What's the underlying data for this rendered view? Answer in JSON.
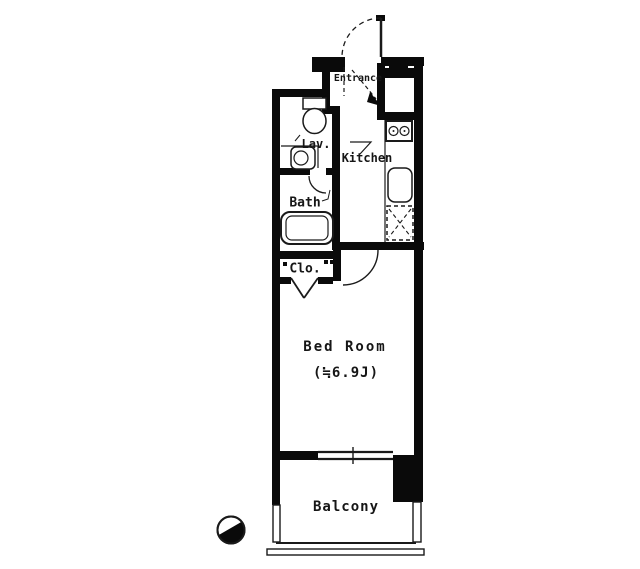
{
  "meta": {
    "type": "apartment-floor-plan"
  },
  "colors": {
    "wall": "#0a0a0a",
    "line": "#1a1a1a",
    "background": "#ffffff"
  },
  "rooms": {
    "entrance": {
      "label": "Entrance"
    },
    "lavatory": {
      "label": "Lav."
    },
    "kitchen": {
      "label": "Kitchen"
    },
    "bath": {
      "label": "Bath"
    },
    "closet": {
      "label": "Clo."
    },
    "bedroom": {
      "label": "Bed Room",
      "area": "(≒6.9J)"
    },
    "balcony": {
      "label": "Balcony"
    }
  },
  "fixtures": [
    {
      "name": "toilet",
      "room": "lavatory"
    },
    {
      "name": "washbasin",
      "room": "lavatory"
    },
    {
      "name": "bathtub",
      "room": "bath"
    },
    {
      "name": "stove-two-burner",
      "room": "kitchen"
    },
    {
      "name": "kitchen-sink",
      "room": "kitchen"
    },
    {
      "name": "refrigerator-space",
      "room": "kitchen"
    },
    {
      "name": "meter-box",
      "room": "entrance"
    },
    {
      "name": "closet-folding-door",
      "room": "closet"
    },
    {
      "name": "entrance-door-swing",
      "room": "entrance"
    },
    {
      "name": "bedroom-door-swing",
      "room": "bedroom"
    },
    {
      "name": "bath-door-swing",
      "room": "bath"
    },
    {
      "name": "sliding-window",
      "room": "bedroom"
    }
  ],
  "symbols": {
    "north_indicator": "compass-wedge"
  }
}
